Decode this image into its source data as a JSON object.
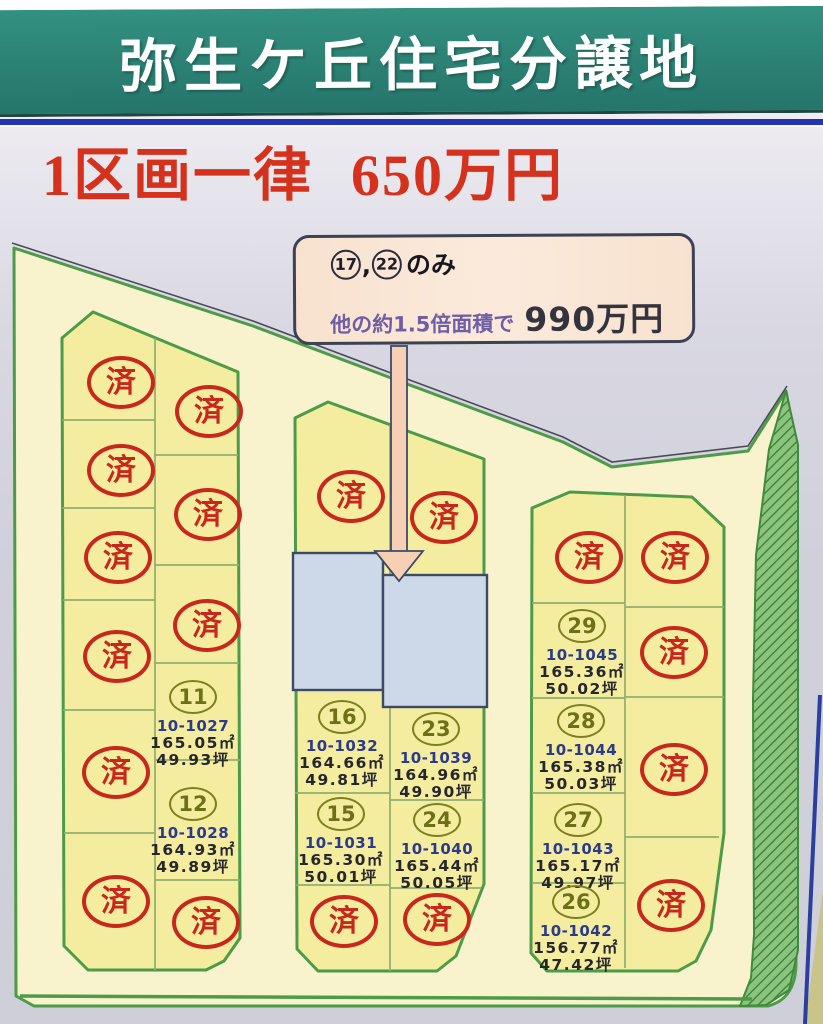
{
  "banner": {
    "title": "弥生ケ丘住宅分譲地"
  },
  "price_banner": {
    "label": "1区画一律",
    "price": "650万円"
  },
  "callout": {
    "num1": "17",
    "comma": ",",
    "num2": "22",
    "only_suffix": "のみ",
    "line2_text": "他の約1.5倍面積で",
    "line2_price": "990万円"
  },
  "map": {
    "sold_label": "済",
    "highlighted_lot_numbers": [
      "17",
      "22"
    ],
    "lots": [
      {
        "number": "11",
        "code": "10-1027",
        "area_m2": "165.05㎡",
        "area_tsubo": "49.93坪"
      },
      {
        "number": "12",
        "code": "10-1028",
        "area_m2": "164.93㎡",
        "area_tsubo": "49.89坪"
      },
      {
        "number": "16",
        "code": "10-1032",
        "area_m2": "164.66㎡",
        "area_tsubo": "49.81坪"
      },
      {
        "number": "23",
        "code": "10-1039",
        "area_m2": "164.96㎡",
        "area_tsubo": "49.90坪"
      },
      {
        "number": "15",
        "code": "10-1031",
        "area_m2": "165.30㎡",
        "area_tsubo": "50.01坪"
      },
      {
        "number": "24",
        "code": "10-1040",
        "area_m2": "165.44㎡",
        "area_tsubo": "50.05坪"
      },
      {
        "number": "29",
        "code": "10-1045",
        "area_m2": "165.36㎡",
        "area_tsubo": "50.02坪"
      },
      {
        "number": "28",
        "code": "10-1044",
        "area_m2": "165.38㎡",
        "area_tsubo": "50.03坪"
      },
      {
        "number": "27",
        "code": "10-1043",
        "area_m2": "165.17㎡",
        "area_tsubo": "49.97坪"
      },
      {
        "number": "26",
        "code": "10-1042",
        "area_m2": "156.77㎡",
        "area_tsubo": "47.42坪"
      }
    ]
  },
  "colors": {
    "banner_teal": "#2b8173",
    "price_red": "#d5321e",
    "sold_stamp_red": "#c8281c",
    "block_yellow": "#f4eda0",
    "road_yellow": "#f8f3cd",
    "boundary_green": "#4d9b48",
    "highlight_lot_blue": "#cdd8e8",
    "lot_number_olive": "#6e7018",
    "lot_code_navy": "#2c3a8a",
    "callout_peach": "#f8e2cf",
    "frame_blue": "#2334b0"
  }
}
